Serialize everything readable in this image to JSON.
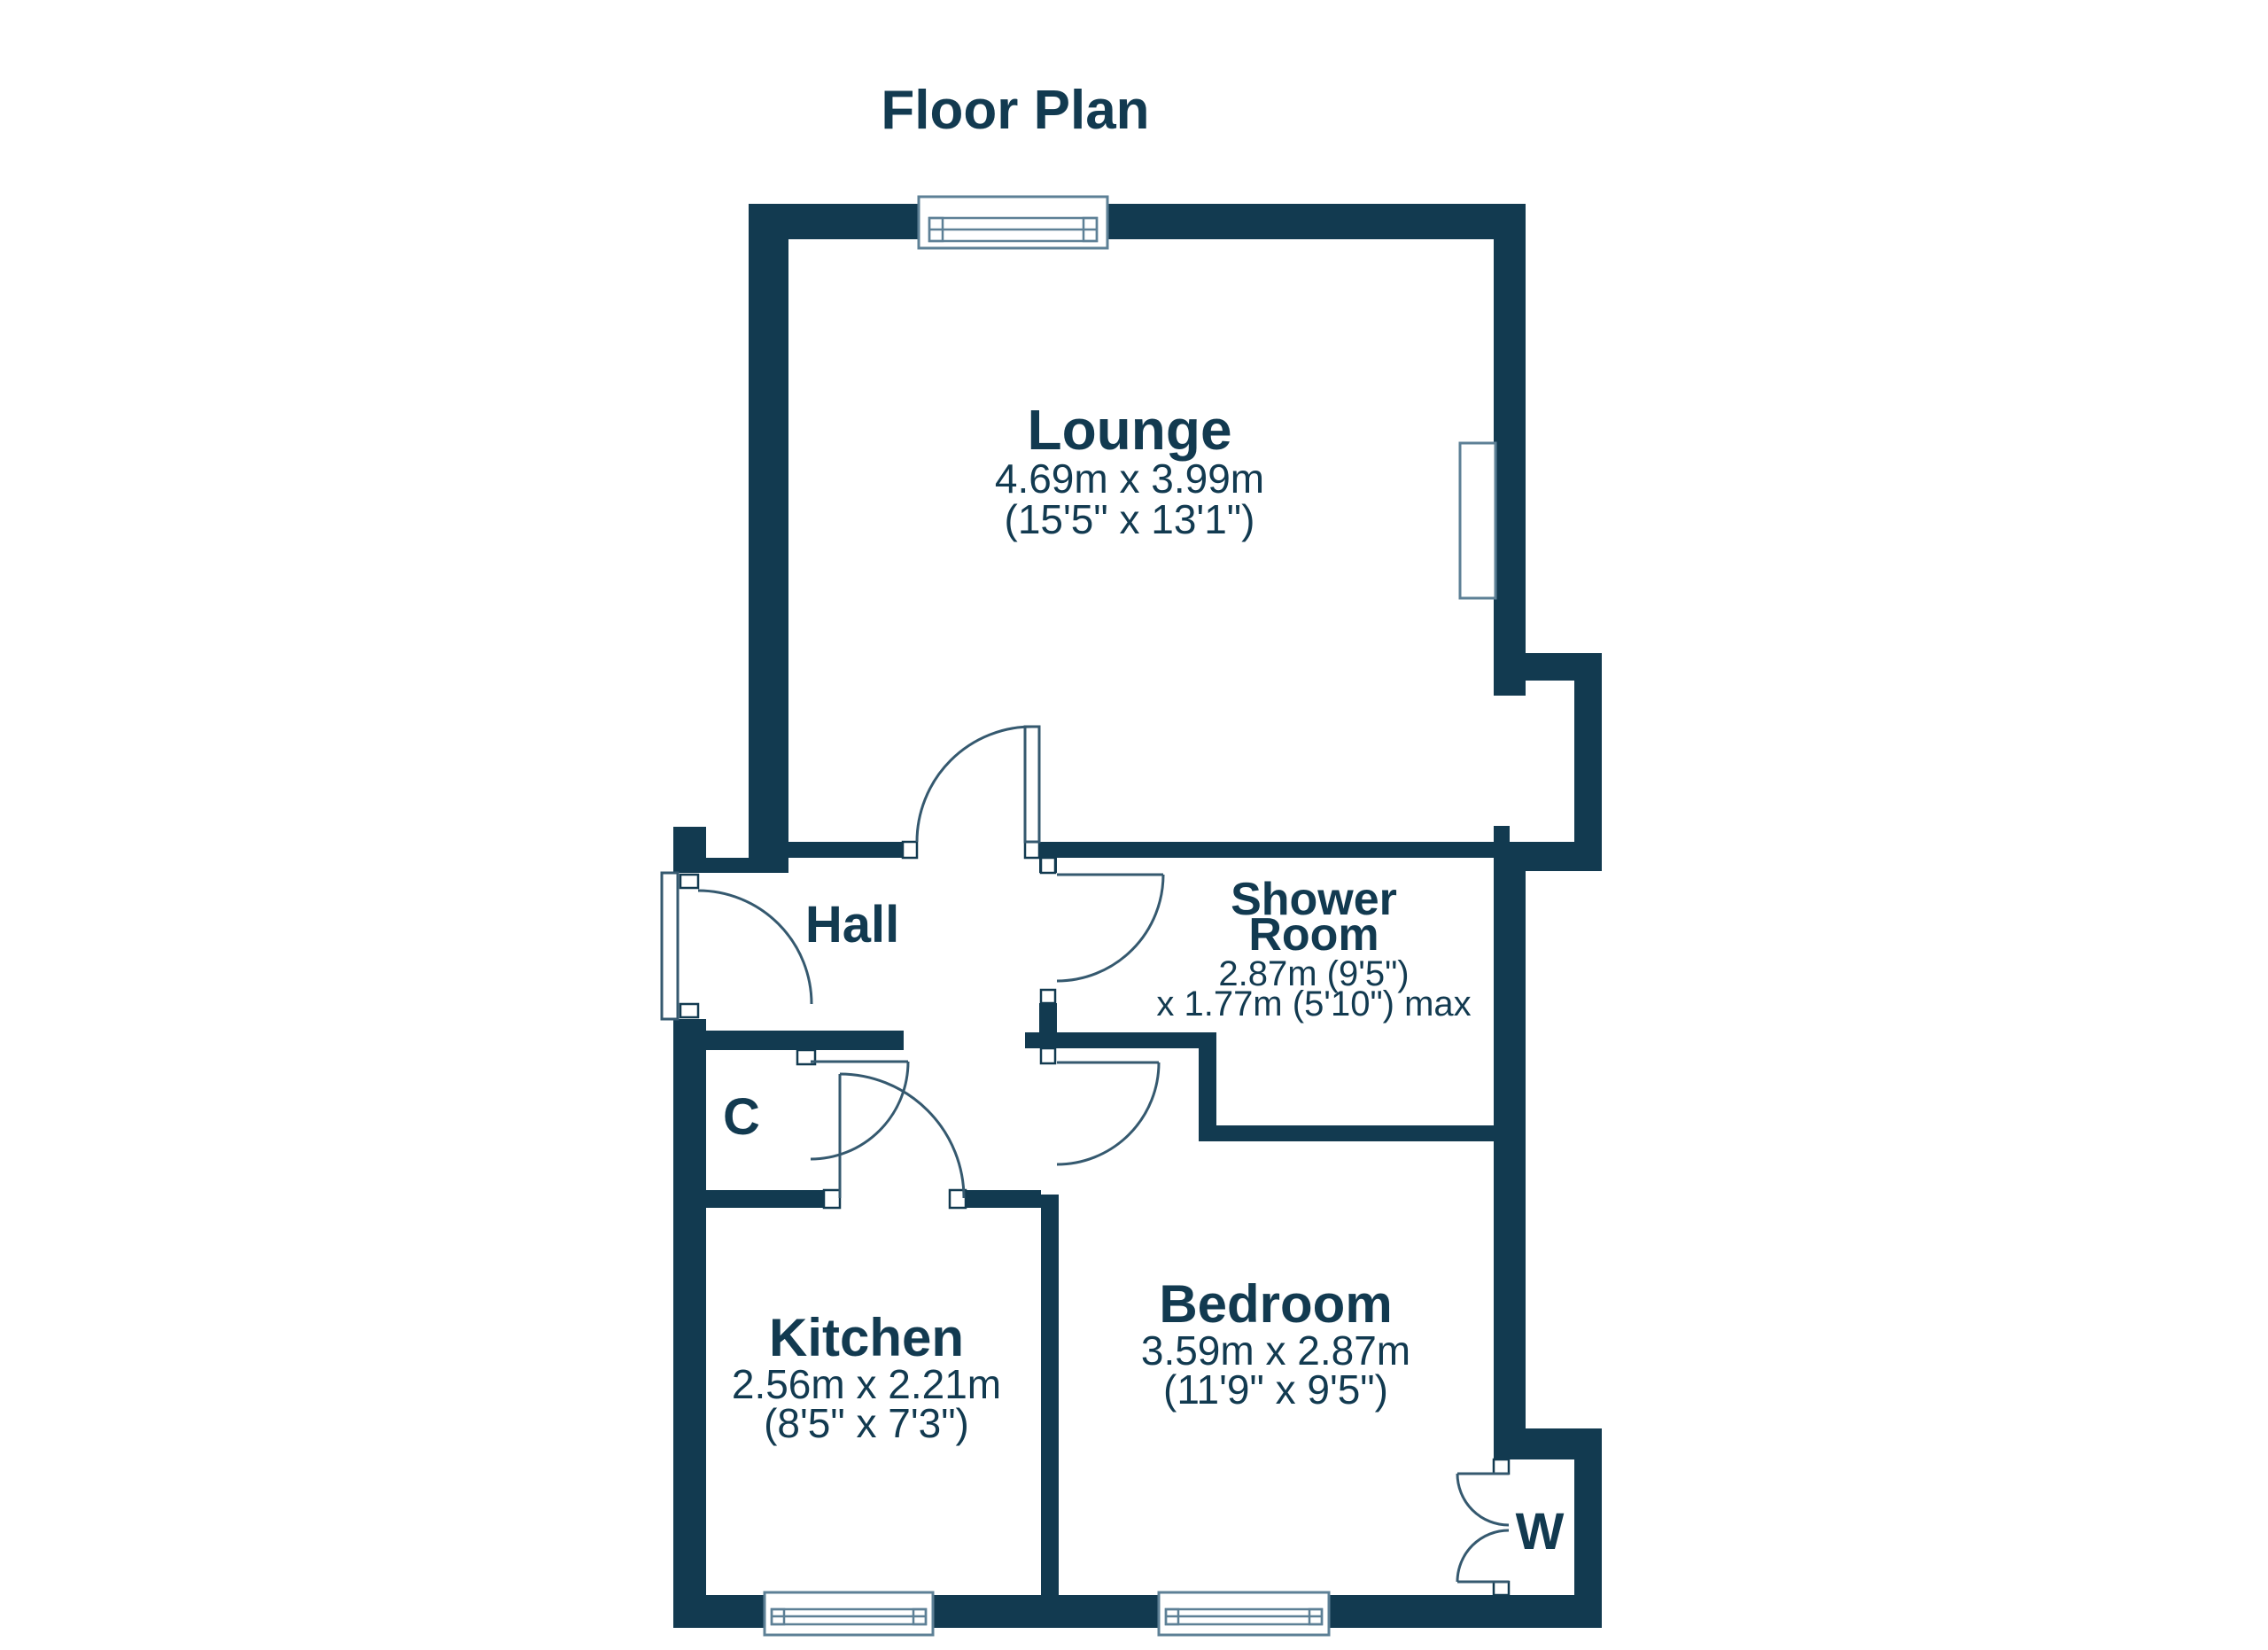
{
  "title": "Floor Plan",
  "colors": {
    "wall": "#123A50",
    "text": "#123A50",
    "door_line": "#35596F",
    "window_line": "#5D8096",
    "background": "#FFFFFF"
  },
  "rooms": {
    "lounge": {
      "name": "Lounge",
      "dims_m": "4.69m x 3.99m",
      "dims_ft": "(15'5\" x 13'1\")"
    },
    "hall": {
      "name": "Hall"
    },
    "shower": {
      "name_line1": "Shower",
      "name_line2": "Room",
      "dims_line1": "2.87m (9'5\")",
      "dims_line2": "x 1.77m (5'10\") max"
    },
    "cupboard": {
      "name": "C"
    },
    "kitchen": {
      "name": "Kitchen",
      "dims_m": "2.56m x 2.21m",
      "dims_ft": "(8'5\" x 7'3\")"
    },
    "bedroom": {
      "name": "Bedroom",
      "dims_m": "3.59m x 2.87m",
      "dims_ft": "(11'9\" x 9'5\")"
    },
    "wardrobe": {
      "name": "W"
    }
  }
}
